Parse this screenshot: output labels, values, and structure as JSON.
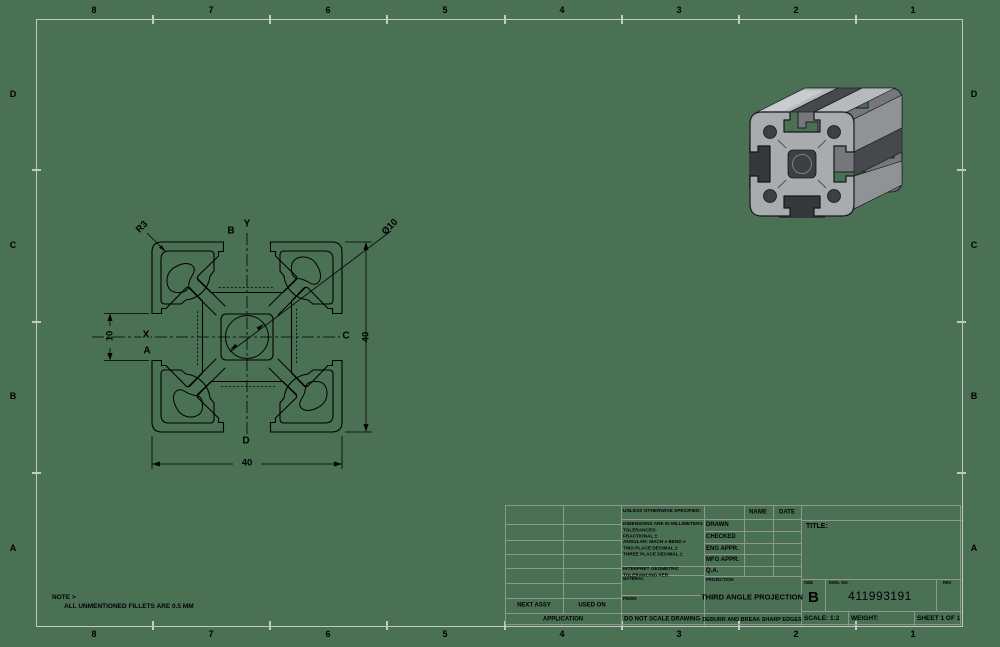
{
  "sheet": {
    "background_color": "#4b7155",
    "frame_color": "#c3cac3",
    "line_color": "#000000",
    "zone_cols": [
      "8",
      "7",
      "6",
      "5",
      "4",
      "3",
      "2",
      "1"
    ],
    "zone_rows": [
      "D",
      "C",
      "B",
      "A"
    ]
  },
  "note": {
    "line1": "NOTE >",
    "line2": "ALL UNMENTIONED FILLETS ARE 0.5 MM"
  },
  "section": {
    "dim_width": "40",
    "dim_height": "40",
    "dim_slot": "10",
    "dim_fillet": "R3",
    "dim_bore": "Ø10",
    "axis": {
      "top_left": "B",
      "top": "Y",
      "left": "X",
      "left_lower": "A",
      "right": "C",
      "bottom": "D"
    }
  },
  "title_block": {
    "unless": "UNLESS OTHERWISE SPECIFIED:",
    "spec": [
      "DIMENSIONS ARE IN MILLIMETERS",
      "TOLERANCES:",
      "FRACTIONAL ±",
      "ANGULAR: MACH ±   BEND ±",
      "TWO PLACE DECIMAL    ±",
      "THREE PLACE DECIMAL   ±"
    ],
    "interpret": [
      "INTERPRET GEOMETRIC",
      "TOLERANCING PER:"
    ],
    "material": "MATERIAL",
    "finish": "FINISH",
    "do_not_scale": "DO NOT SCALE DRAWING",
    "name": "NAME",
    "date": "DATE",
    "approvals": [
      "DRAWN",
      "CHECKED",
      "ENG APPR.",
      "MFG APPR.",
      "Q.A."
    ],
    "projection_label": "PROJECTION:",
    "projection": "THIRD ANGLE PROJECTION",
    "deburr": "DEBURR AND BREAK SHARP EDGES",
    "title_label": "TITLE:",
    "size_label": "SIZE",
    "size": "B",
    "dwg_label": "DWG.  NO.",
    "dwg_no": "411993191",
    "rev_label": "REV",
    "scale": "SCALE: 1:2",
    "weight": "WEIGHT:",
    "sheet_of": "SHEET 1 OF 1",
    "next_assy": "NEXT ASSY",
    "used_on": "USED ON",
    "application": "APPLICATION"
  }
}
